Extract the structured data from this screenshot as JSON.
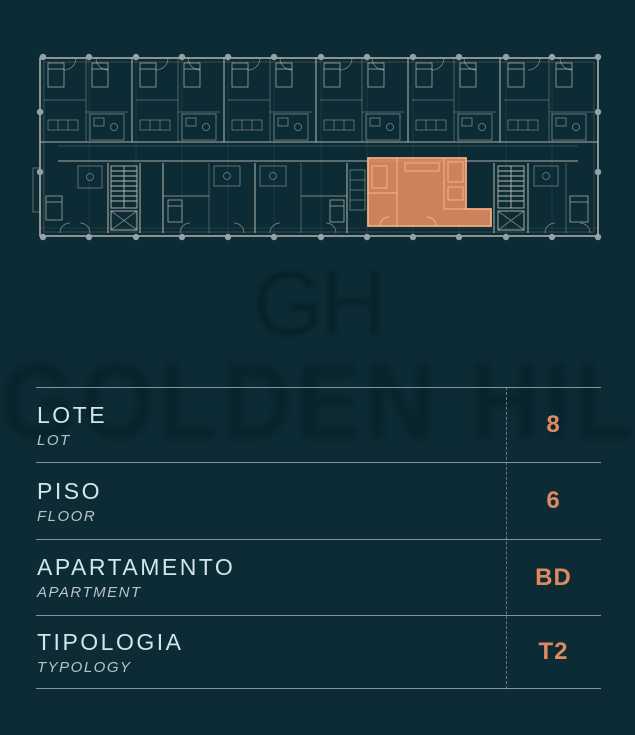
{
  "colors": {
    "background": "#0c2b34",
    "accent": "#de8a60",
    "accent_light": "#f2ad83",
    "plan_line": "#d7d1c3",
    "plan_line_secondary": "#9eb3ba",
    "table_line": "rgba(158,179,184,.8)",
    "label": "#d3e4ea",
    "sublabel": "#b6c3c7",
    "watermark": "#061d24"
  },
  "watermark": {
    "monogram": "GH",
    "band_text": "GOLDEN HILLS"
  },
  "floor_plan": {
    "highlighted_unit": "BD"
  },
  "table": {
    "rows": [
      {
        "label": "LOTE",
        "sublabel": "LOT",
        "value": "8"
      },
      {
        "label": "PISO",
        "sublabel": "FLOOR",
        "value": "6"
      },
      {
        "label": "APARTAMENTO",
        "sublabel": "APARTMENT",
        "value": "BD"
      },
      {
        "label": "TIPOLOGIA",
        "sublabel": "TYPOLOGY",
        "value": "T2"
      }
    ]
  }
}
